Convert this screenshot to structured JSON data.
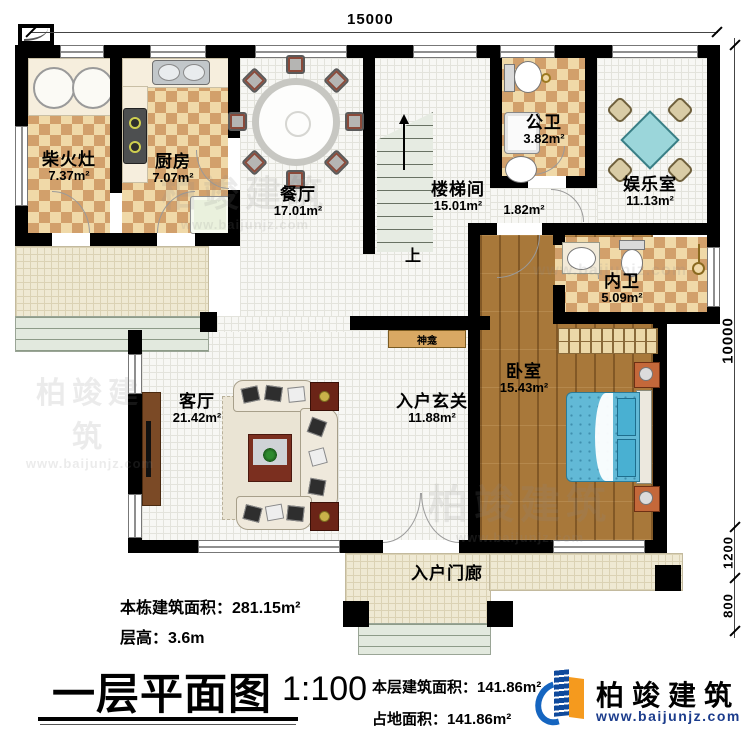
{
  "dim": {
    "top": "15000",
    "right": [
      "10000",
      "1200",
      "800"
    ]
  },
  "rooms": {
    "chaihuozao": {
      "name": "柴火灶",
      "area": "7.37m²"
    },
    "kitchen": {
      "name": "厨房",
      "area": "7.07m²"
    },
    "dining": {
      "name": "餐厅",
      "area": "17.01m²"
    },
    "stairwell": {
      "name": "楼梯间",
      "area": "15.01m²"
    },
    "public_bath": {
      "name": "公卫",
      "area": "3.82m²"
    },
    "entertainment": {
      "name": "娱乐室",
      "area": "11.13m²"
    },
    "inner_bath": {
      "name": "内卫",
      "area": "5.09m²"
    },
    "bedroom": {
      "name": "卧室",
      "area": "15.43m²"
    },
    "living": {
      "name": "客厅",
      "area": "21.42m²"
    },
    "foyer": {
      "name": "入户玄关",
      "area": "11.88m²"
    },
    "porch": {
      "name": "入户门廊"
    }
  },
  "corridor": {
    "area": "1.82m²"
  },
  "shrine": {
    "name": "神龛"
  },
  "stairs": {
    "up": "上"
  },
  "info": {
    "total_area": "本栋建筑面积：281.15m²",
    "floor_height": "层高：3.6m"
  },
  "titleblock": {
    "title": "一层平面图",
    "scale": "1:100",
    "floor_area": "本层建筑面积：141.86m²",
    "footprint": "占地面积：141.86m²"
  },
  "logo": {
    "name": "柏竣建筑",
    "url": "www.baijunjz.com"
  },
  "watermark": {
    "text": "柏竣建筑",
    "url": "www.baijunjz.com"
  },
  "colors": {
    "wall": "#000000",
    "checker_dark": "#d2a06b",
    "checker_light": "#f0d9a8",
    "wood": "#a8783a",
    "bed_blue": "#62b9d6",
    "tile": "#efe9d3",
    "stair": "#e6ebe2",
    "logo_blue": "#1565c0",
    "logo_orange": "#f59a1e",
    "url_blue": "#1b3c8c"
  }
}
